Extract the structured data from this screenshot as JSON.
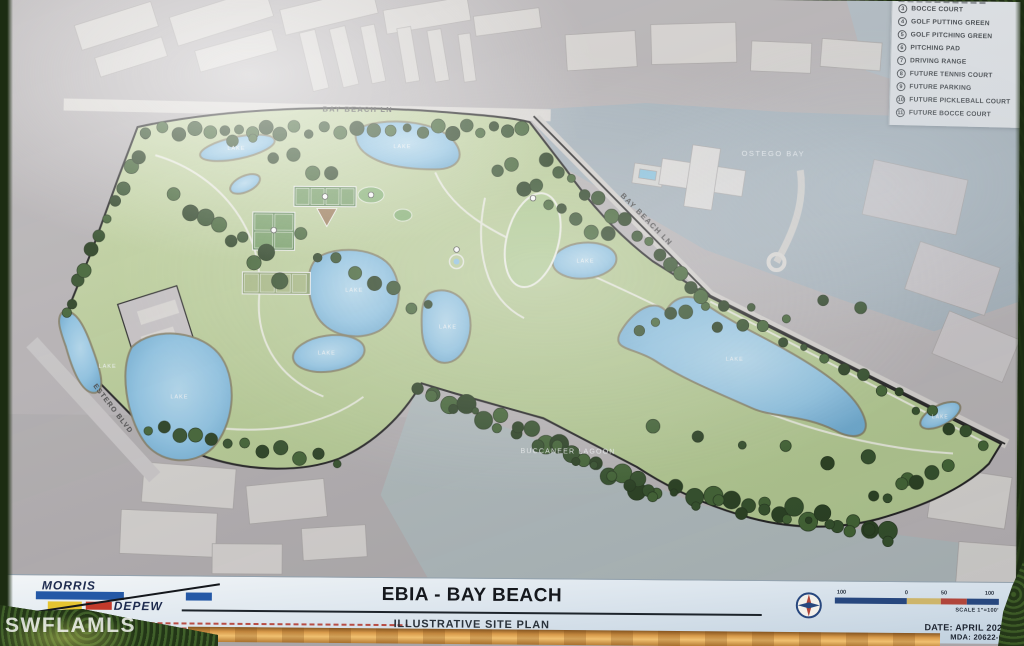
{
  "photo": {
    "watermark": "SWFLAMLS"
  },
  "sign": {
    "legend": {
      "items": [
        {
          "num": "3",
          "label": "BOCCE COURT"
        },
        {
          "num": "4",
          "label": "GOLF PUTTING GREEN"
        },
        {
          "num": "5",
          "label": "GOLF PITCHING GREEN"
        },
        {
          "num": "6",
          "label": "PITCHING PAD"
        },
        {
          "num": "7",
          "label": "DRIVING RANGE"
        },
        {
          "num": "8",
          "label": "FUTURE TENNIS COURT"
        },
        {
          "num": "9",
          "label": "FUTURE PARKING"
        },
        {
          "num": "10",
          "label": "FUTURE PICKLEBALL COURT"
        },
        {
          "num": "11",
          "label": "FUTURE BOCCE COURT"
        }
      ]
    },
    "map_labels": {
      "road_top": "BAY BEACH LN",
      "road_diagonal": "BAY BEACH LN",
      "bay": "OSTEGO BAY",
      "lagoon": "BUCCANEER LAGOON",
      "boulevard": "ESTERO BLVD",
      "lake": "LAKE"
    },
    "title_block": {
      "logo_top": "MORRIS",
      "logo_bottom": "DEPEW",
      "title": "EBIA - BAY BEACH",
      "subtitle": "ILLUSTRATIVE SITE PLAN",
      "date": "DATE: APRIL 2022",
      "mda": "MDA: 20622-01",
      "scale_left": "100",
      "scale_zero": "0",
      "scale_mid": "50",
      "scale_right": "100",
      "scale_caption": "SCALE 1\"=100'"
    }
  },
  "colors": {
    "plan_green": "#b9cf9b",
    "lake_blue": "#8cc3e4",
    "bay_gray": "#a9b6bd",
    "rail_orange": "#d89a4a",
    "accent_navy": "#27477e",
    "tree_green": "#2d4a24"
  }
}
